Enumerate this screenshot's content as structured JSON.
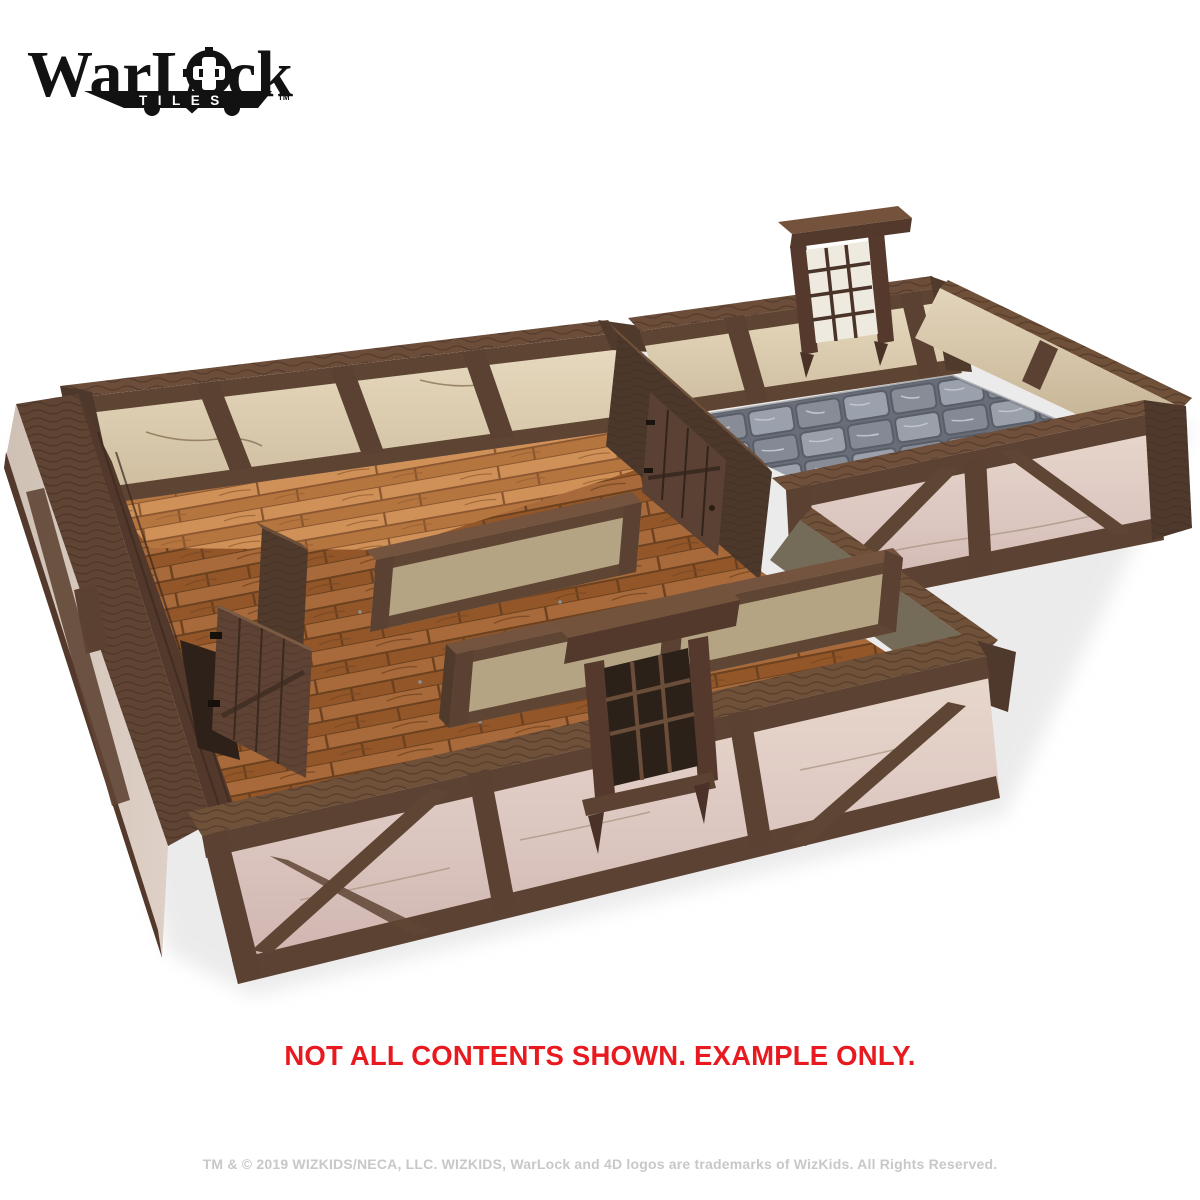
{
  "logo": {
    "brand_full": "WarLock",
    "brand_part1": "WarL",
    "brand_part2": "ck",
    "sub": "TILES",
    "tm": "TM",
    "gear_icon": "puzzle-clip-o-glyph",
    "color": "#121212"
  },
  "disclaimer": {
    "text": "NOT ALL CONTENTS SHOWN. EXAMPLE ONLY.",
    "color": "#e8191f"
  },
  "legal": {
    "text": "TM & © 2019 WIZKIDS/NECA, LLC. WIZKIDS, WarLock and 4D logos are trademarks of WizKids. All Rights Reserved.",
    "color": "#c8c8c8"
  },
  "scene": {
    "subject": "timber-framed modular room tiles, isometric product render",
    "palette": {
      "beam_wood": "#5a4031",
      "beam_wood_dark": "#3c2b21",
      "beam_wood_light": "#74533d",
      "plaster_cream": "#e2d4b8",
      "plaster_pink": "#ddc9c4",
      "panel_khaki": "#b4a483",
      "floor_plank_light": "#c2824c",
      "floor_plank_deep": "#9d5f31",
      "stone_floor": "#8b909b",
      "background": "#ffffff"
    }
  }
}
